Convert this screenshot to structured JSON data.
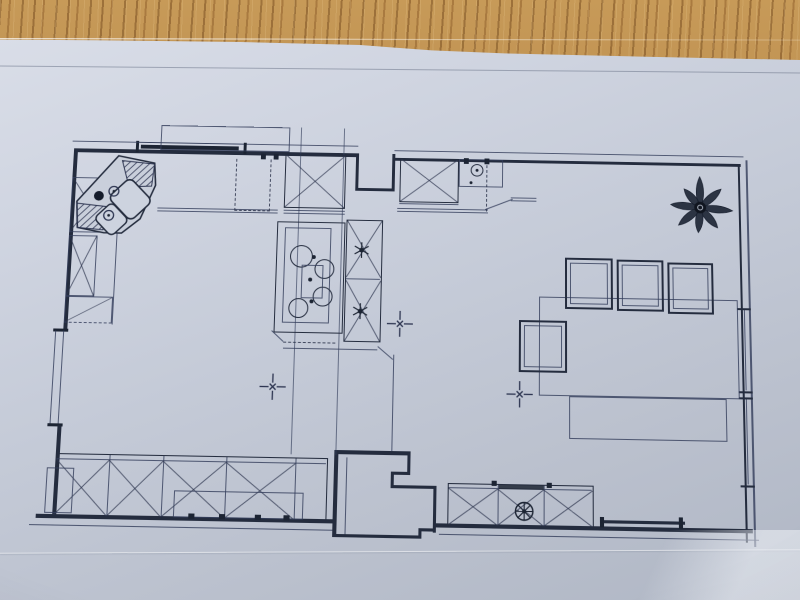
{
  "scene": {
    "title": "Photographed architectural floor plan of a kitchen and dining room lying on a wooden table",
    "media": "pencil/CAD print on light blue-grey paper",
    "table_surface": "oak wood grain",
    "visible_text": ""
  },
  "palette": {
    "ink": "#242c3e",
    "thin_ink": "#3c4662",
    "paper": "#c6ccd9",
    "paper_highlight": "#dbdfe9",
    "paper_shadow": "#b0b7c5",
    "wood": "#b5874a",
    "wood_dark": "#7c4f22",
    "wood_light": "#c79a58"
  },
  "plan": {
    "title": "Kitchen and dining room floor plan",
    "rooms": [
      {
        "name": "kitchen",
        "position": "left"
      },
      {
        "name": "dining-room",
        "position": "right"
      }
    ],
    "fixtures": {
      "corner_sink": {
        "basins": 2,
        "drainers": 2,
        "orientation": "45deg in top-left corner"
      },
      "cooktop": {
        "burners": 4,
        "location": "kitchen centre column"
      },
      "dishwasher_dashed": 1,
      "x_marked_cabinets": 12,
      "dining_chairs": 4,
      "dining_table": 1,
      "bench_or_rug": 1,
      "potted_plant": 1,
      "extractor_fan_circle": 1,
      "centerline_cross_marks": 3,
      "windows": {
        "left_wall": 1,
        "top_wall": 1,
        "right_wall": 2
      },
      "entry_step_recess": "bottom centre stepped wall",
      "door_threshold": "bottom right sliding door sill"
    }
  }
}
